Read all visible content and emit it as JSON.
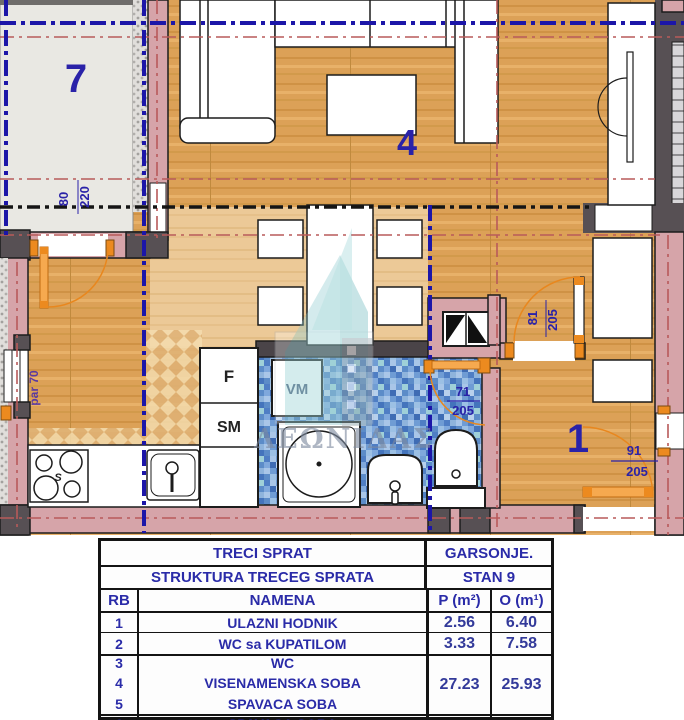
{
  "plan": {
    "room_labels": {
      "balcony": "7",
      "living": "4",
      "hall": "1"
    },
    "fixtures": {
      "fridge": "F",
      "dishwasher": "SM",
      "washing_machine": "VM",
      "stove": "S"
    },
    "dims": {
      "balcony_door_w": "80",
      "balcony_door_h": "220",
      "window_parapet": "par 70",
      "bath_door_w": "71",
      "bath_door_h": "205",
      "room_door_w": "81",
      "room_door_h": "205",
      "entry_door_w": "91",
      "entry_door_h": "205"
    },
    "watermark": "ΛΕΩΝΙΔΑΣ",
    "colors": {
      "wood": "#dca157",
      "wall_pink": "#d6a4a9",
      "navy": "#2721a5",
      "orange": "#ec8a1f",
      "mosaic": "#6f9cd4",
      "dark_wall": "#575054"
    }
  },
  "table": {
    "floor_title": "TRECI SPRAT",
    "structure_title": "STRUKTURA TRECEG SPRATA",
    "apt_type": "GARSONJE.",
    "apt_no": "STAN 9",
    "col_rb": "RB",
    "col_name": "NAMENA",
    "col_p": "P (m²)",
    "col_o": "O (m¹)",
    "rows": [
      {
        "rb": "1",
        "name": "ULAZNI HODNIK",
        "p": "2.56",
        "o": "6.40"
      },
      {
        "rb": "2",
        "name": "WC sa KUPATILOM",
        "p": "3.33",
        "o": "7.58"
      }
    ],
    "group": {
      "rb3": "3",
      "rb4": "4",
      "rb5": "5",
      "name3": "WC",
      "name4": "VISENAMENSKA SOBA",
      "name5": "SPAVACA SOBA",
      "p": "27.23",
      "o": "25.93"
    },
    "partial_row": {
      "rb": "6",
      "name": "SPAVACA SOBA"
    }
  }
}
